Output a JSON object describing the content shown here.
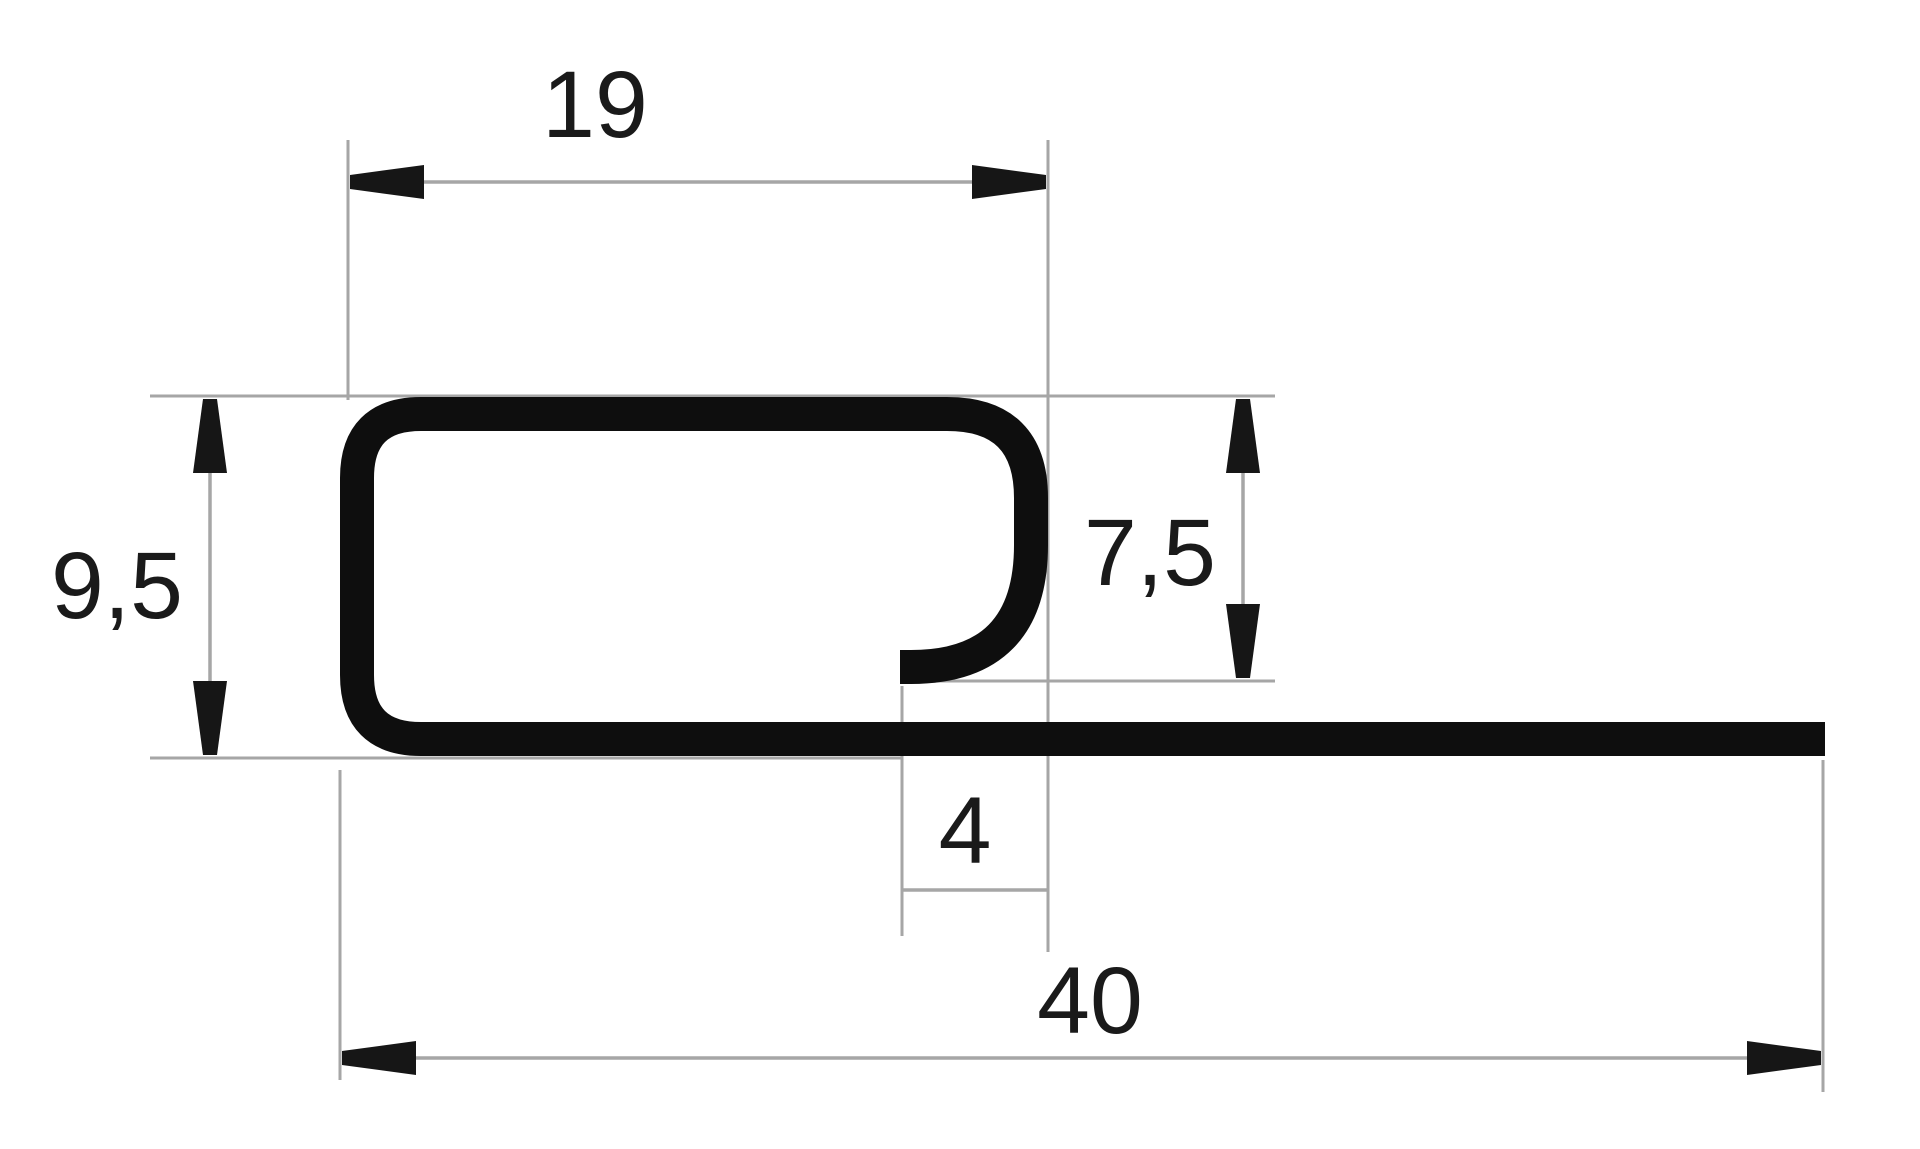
{
  "drawing": {
    "type": "technical-profile-cross-section",
    "description": "Dimensioned cross-section of a J-trim edge profile",
    "colors": {
      "background": "#ffffff",
      "line": "#a6a6a6",
      "arrow": "#161616",
      "profile": "#0e0e0e",
      "text": "#1a1a1a"
    },
    "dimensions": [
      {
        "id": "top-width",
        "label": "19",
        "orientation": "horizontal"
      },
      {
        "id": "left-height",
        "label": "9,5",
        "orientation": "vertical"
      },
      {
        "id": "hook-depth",
        "label": "7,5",
        "orientation": "vertical"
      },
      {
        "id": "hook-offset",
        "label": "4",
        "orientation": "horizontal"
      },
      {
        "id": "total-length",
        "label": "40",
        "orientation": "horizontal"
      }
    ]
  }
}
